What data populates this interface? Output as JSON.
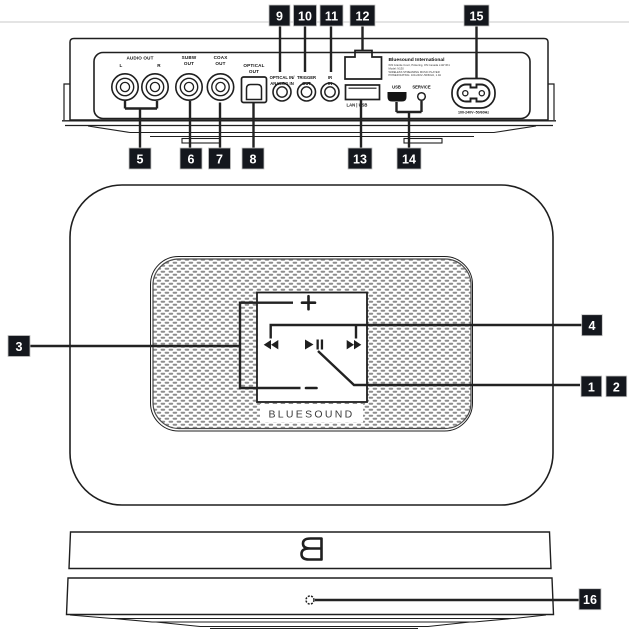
{
  "branding": {
    "wordmark": "BLUESOUND"
  },
  "badges": [
    "1",
    "2",
    "3",
    "4",
    "5",
    "6",
    "7",
    "8",
    "9",
    "10",
    "11",
    "12",
    "13",
    "14",
    "15",
    "16"
  ],
  "rear": {
    "labels": {
      "audio_out": "AUDIO OUT",
      "left": "L",
      "right": "R",
      "subw": [
        "SUBW",
        "OUT"
      ],
      "coax": [
        "COAX",
        "OUT"
      ],
      "optical_out": [
        "OPTICAL",
        "OUT"
      ],
      "optical_in": [
        "OPTICAL IN/",
        "ANALOG IN"
      ],
      "trigger": [
        "TRIGGER",
        "OUT"
      ],
      "ir": [
        "IR",
        "IN"
      ],
      "lan_usb": "LAN | USB",
      "usb": "USB",
      "service": "SERVICE",
      "power_rating": "100-240V~50/60Hz"
    },
    "info": [
      "Bluesound International",
      "633 Granite Court, Pickering, ON Canada L1W 3K1",
      "Model: N130",
      "WIRELESS STREAMING MUSIC PLAYER",
      "POWER RATING: 100-240V~50/60Hz, 1.3A"
    ]
  },
  "icons": {
    "volume_up": "+",
    "volume_down": "−",
    "skip_back": "◀◀",
    "play_pause": "▶❘❘",
    "skip_forward": "▶▶",
    "logo_b": "mirrored-B",
    "status_led": "circle"
  },
  "colors": {
    "ink": "#1f1f1f",
    "badge_bg": "#14171d",
    "badge_text": "#ffffff",
    "top_rule": "#dcdcdc",
    "grille_dot": "#8d8d8d"
  }
}
